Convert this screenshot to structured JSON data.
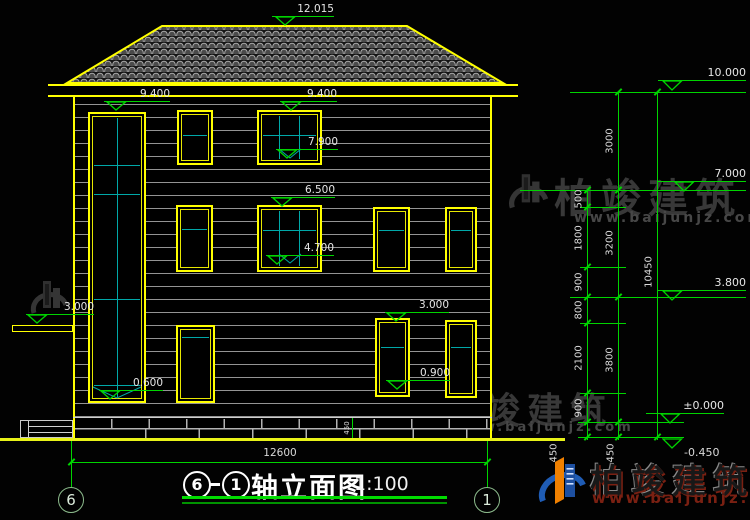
{
  "watermark": {
    "brand": "柏竣建筑",
    "url": "www.baijunjz.com"
  },
  "roof": {
    "ridge_elevation": "12.015"
  },
  "facade": {
    "elev_9400_left": "9.400",
    "elev_9400_right": "9.400",
    "elev_7900": "7.900",
    "elev_6500": "6.500",
    "elev_4700": "4.700",
    "elev_3000_right": "3.000",
    "elev_0900": "0.900",
    "elev_0600": "0.600",
    "elev_3000_left": "3.000"
  },
  "right_dims": {
    "levels": {
      "l10000": "10.000",
      "l7000": "7.000",
      "l3800": "3.800",
      "l0000": "±0.000",
      "lm0450": "-0.450"
    },
    "inner_chain": {
      "s1": "500",
      "s2": "1800",
      "s3": "900",
      "s4": "800",
      "s5": "2100",
      "s6": "900",
      "s7": "450"
    },
    "outer_chain": {
      "s1": "3000",
      "s2": "3200",
      "s3": "3800",
      "s4": "450"
    },
    "total": "10450"
  },
  "base": {
    "height": "450"
  },
  "bottom": {
    "width": "12600",
    "axis_left": "6",
    "axis_right": "1"
  },
  "title": {
    "axis_left": "6",
    "axis_right": "1",
    "text": "轴立面图",
    "scale": "1:100"
  },
  "colors": {
    "accent_yellow": "#ffff00",
    "dim_green": "#00d400",
    "mullion_cyan": "#00a8a8",
    "watermark_gray": "#383838",
    "brand_blue": "#1f5cb5",
    "brand_orange": "#f08000"
  }
}
